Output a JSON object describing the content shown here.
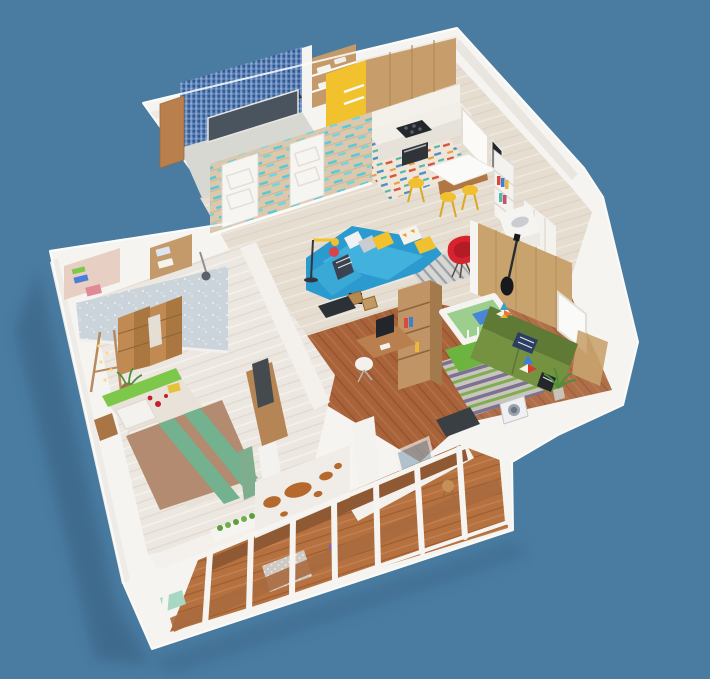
{
  "scene": {
    "type": "3d-floor-plan-render",
    "view": "isometric cutaway of a one-bedroom apartment seen from above",
    "rooms": [
      {
        "name": "bathroom",
        "features": [
          "blue mosaic tile wall",
          "dark bathtub",
          "wooden cabinet"
        ]
      },
      {
        "name": "storage-closet",
        "features": [
          "wooden shelving",
          "white towels"
        ]
      },
      {
        "name": "kitchen",
        "features": [
          "yellow accent wall",
          "wooden upper cabinets",
          "white counter",
          "gas stove",
          "oven",
          "colorful patterned rug"
        ]
      },
      {
        "name": "dining-area",
        "features": [
          "white dining table",
          "three yellow stools",
          "window",
          "dark framed poster"
        ]
      },
      {
        "name": "living-room",
        "features": [
          "blue corner sofa",
          "yellow pillows",
          "white pillows",
          "arc floor lamp",
          "red armchair",
          "grey striped rug",
          "wooden crate tables",
          "dark tv cabinet",
          "white bookshelf with books",
          "white dresser",
          "sheer curtain window"
        ]
      },
      {
        "name": "study-nook",
        "features": [
          "wooden desk",
          "monitor",
          "white swivel chair",
          "wooden shelving divider",
          "dark wood floor"
        ]
      },
      {
        "name": "nursery",
        "features": [
          "white crib",
          "green mattress",
          "blue blanket",
          "green sofa",
          "pinwheel pillows",
          "navy striped pillow",
          "striped rug",
          "green rug",
          "wood panel wall",
          "electric guitar",
          "potted plant",
          "window",
          "washing machine"
        ]
      },
      {
        "name": "bedroom",
        "features": [
          "patterned wallpaper wall",
          "closet shelves with boxes and towels",
          "wooden folding screen",
          "double bed",
          "tan duvet with green stripes",
          "lime headboard",
          "white pillows",
          "green pillow",
          "easel with string lights",
          "wicker basket",
          "wooden dresser with mirror",
          "rose petals",
          "yellow book",
          "curtains"
        ]
      },
      {
        "name": "hallway",
        "features": [
          "two white panel doors",
          "wood plank wall with teal accents"
        ]
      },
      {
        "name": "balcony",
        "features": [
          "wooden floor",
          "white window frames",
          "world map wall art",
          "grey dotted rug",
          "white planter with greenery",
          "mint bench",
          "small wooden stool",
          "purple flowers",
          "glass door"
        ]
      }
    ]
  },
  "colors": {
    "background": "#4a7ca2",
    "shadow": "#1e3a52",
    "wall_white": "#f6f4f1",
    "wall_inner": "#edeae5",
    "bathroom_floor": "#d8d8d2",
    "mosaic_base": "#3f69a4",
    "tub_front": "#4a545e",
    "tub_top": "#2f3840",
    "cabinet_wood": "#c79e6b",
    "wood_dark": "#a37a4c",
    "shelf_wood": "#c59a6a",
    "accent_yellow": "#f2c12e",
    "stool_yellow": "#f0c030",
    "counter_white": "#f2efe9",
    "counter_front": "#e6e2da",
    "stove_dark": "#24272b",
    "oven_dark": "#303438",
    "sofa_blue": "#2b9ace",
    "sofa_blue_light": "#43b1dd",
    "chair_red": "#d8232e",
    "sofa_green_back": "#5f7a35",
    "sofa_green_seat": "#74923f",
    "crib_mattress": "#9ccf8e",
    "crib_white": "#f4f3ef",
    "blanket_blue": "#4a86d8",
    "rug_green": "#6db33f",
    "bed_tan": "#b28b70",
    "bed_stripe": "#74b18e",
    "headboard_green": "#7dc84a",
    "pillow_green": "#2f8f4a",
    "pillow_white": "#f3f2ee",
    "map_brown": "#b5692c",
    "map_wall": "#f0ede8",
    "door_white": "#f7f5f2",
    "door_wall_wood": "#dcc9ad",
    "teal_accent": "#5bc8d8",
    "curtain_white": "#f4f2ee",
    "curtain_green": "#7fae8f",
    "plant_green": "#4c8f3a",
    "rug_grey": "#c9c8c4",
    "guitar_black": "#17191c",
    "monitor_dark": "#22262b",
    "tv_cabinet": "#2c3136",
    "washer_white": "#eef0f2",
    "screen_wood": "#c08a52",
    "screen_wood_dark": "#a9773f",
    "desk_wood": "#b97f4e",
    "table_white": "#fafaf8",
    "glass_blue": "#8fa8ba",
    "mint_seat": "#a8d8c4",
    "poster_dark": "#23262a",
    "basket_brown": "#9a7448",
    "petal_red": "#c41f2a",
    "book_yellow": "#e6c13a",
    "flower_purple": "#8a5fb5",
    "dresser_mirror": "#454a4f"
  }
}
